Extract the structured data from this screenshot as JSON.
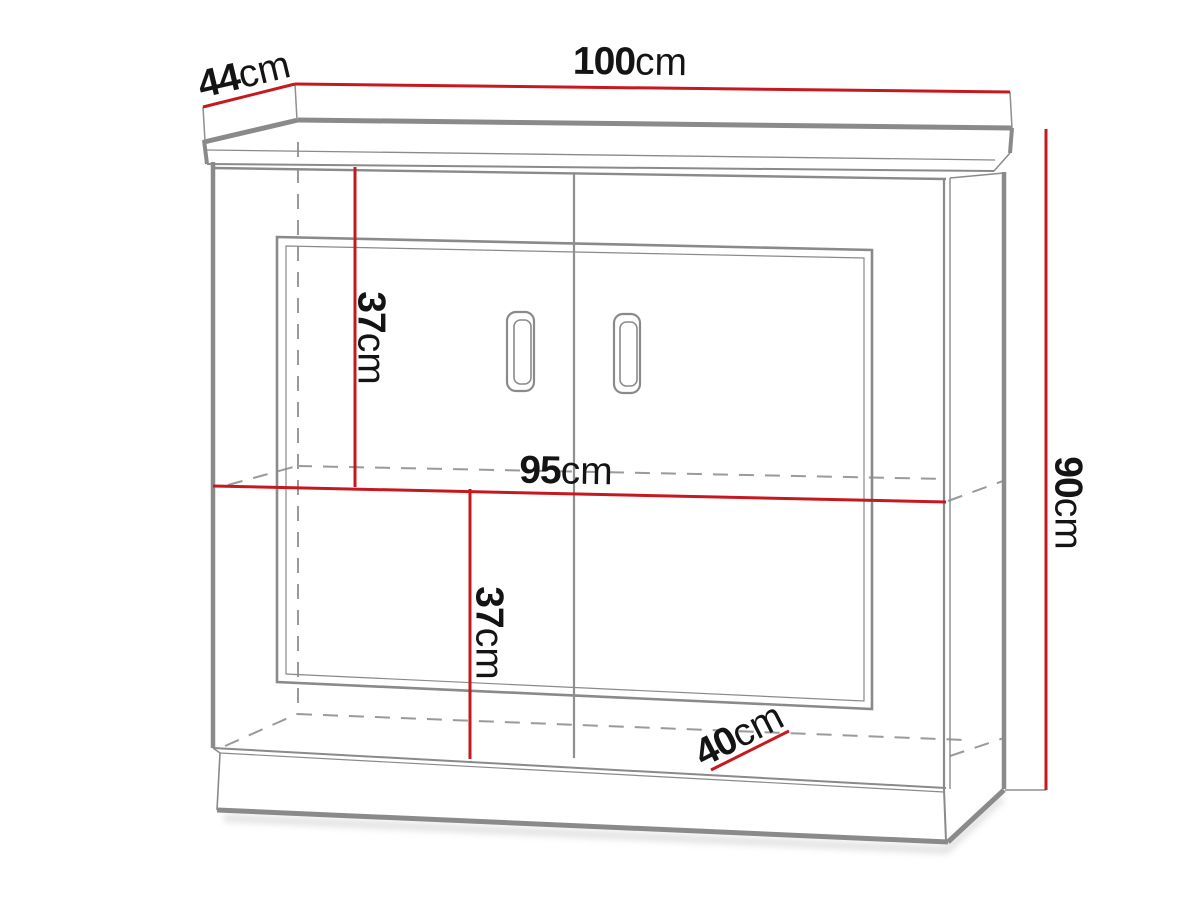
{
  "diagram": {
    "type": "furniture-dimension-drawing",
    "subject": "two-door sideboard cabinet with top panel, plinth and middle shelf",
    "colors": {
      "dimension_line": "#c6191f",
      "outline_gray": "#8a8a8a",
      "hidden_edge_gray": "#9a9a9a",
      "label_text": "#141414",
      "background": "#ffffff"
    },
    "dimensions": {
      "top_depth": {
        "value": "44",
        "unit": "cm"
      },
      "total_width": {
        "value": "100",
        "unit": "cm"
      },
      "total_height": {
        "value": "90",
        "unit": "cm"
      },
      "upper_compartment_height": {
        "value": "37",
        "unit": "cm"
      },
      "interior_width": {
        "value": "95",
        "unit": "cm"
      },
      "lower_compartment_height": {
        "value": "37",
        "unit": "cm"
      },
      "interior_depth": {
        "value": "40",
        "unit": "cm"
      }
    }
  }
}
